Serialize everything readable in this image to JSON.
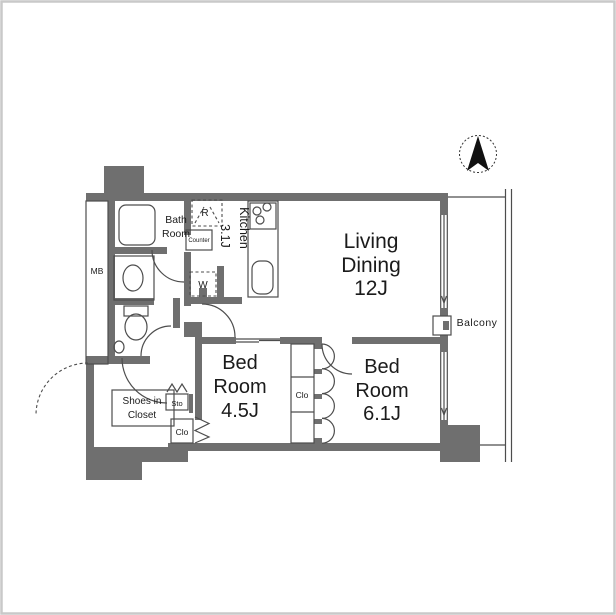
{
  "labels": {
    "living": {
      "line1": "Living",
      "line2": "Dining",
      "line3": "12J"
    },
    "bed_small": {
      "line1": "Bed",
      "line2": "Room",
      "line3": "4.5J"
    },
    "bed_large": {
      "line1": "Bed",
      "line2": "Room",
      "line3": "6.1J"
    },
    "kitchen": {
      "name": "Kitchen",
      "size": "3.1J"
    },
    "bath": {
      "line1": "Bath",
      "line2": "Room"
    },
    "balcony": "Balcony",
    "shoes_closet": {
      "line1": "Shoes in",
      "line2": "Closet"
    },
    "meter_box": "MB",
    "refrigerator": "R",
    "washer": "W",
    "counter": "Counter",
    "storage": "Sto",
    "closet_hall": "Clo",
    "closet_mid": "Clo"
  },
  "colors": {
    "wall": "#6f6f6f",
    "line": "#4d4d4d",
    "text": "#1b1b1b",
    "background": "#ffffff",
    "frame": "#c9c9c9",
    "compass_needle": "#111111"
  }
}
